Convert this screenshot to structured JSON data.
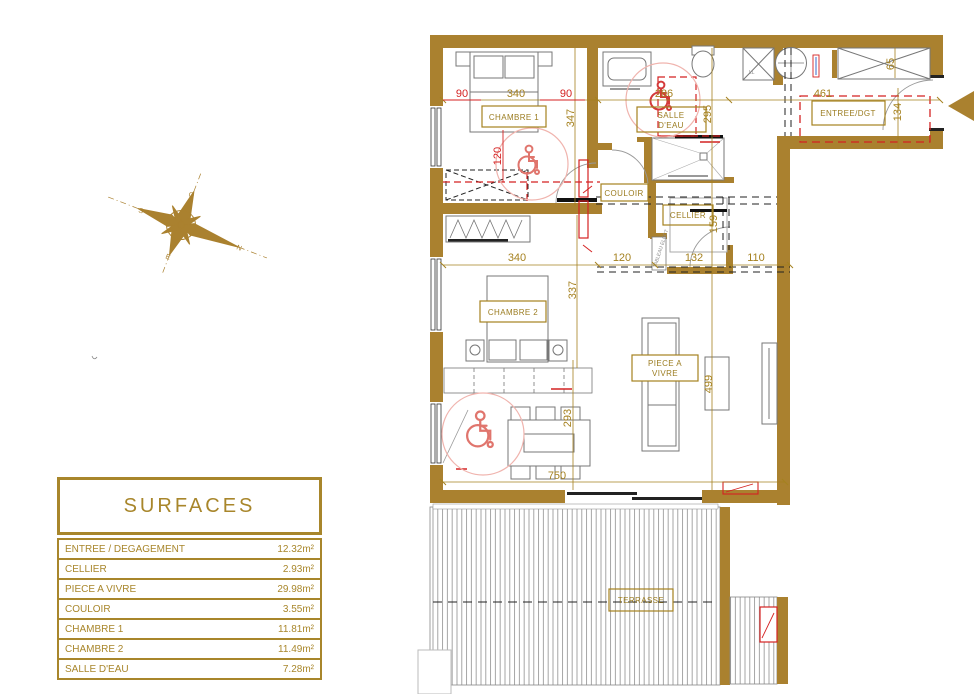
{
  "colors": {
    "wall": "#aa812f",
    "gold": "#a5811f",
    "red": "#d42222",
    "pink": "#f0b4ae",
    "furniture": "#777777"
  },
  "plan": {
    "rooms": {
      "chambre1": "CHAMBRE 1",
      "salle_deau_1": "SALLE",
      "salle_deau_2": "D'EAU",
      "entree": "ENTREE/DGT",
      "couloir": "COULOIR",
      "cellier": "CELLIER",
      "chambre2": "CHAMBRE 2",
      "piece_1": "PIECE A",
      "piece_2": "VIVRE",
      "terrasse": "TERRASSE"
    },
    "dims": {
      "ch1_width": "340",
      "ch1_height": "347",
      "sde_width": "286",
      "sde_height": "295",
      "entree_width": "461",
      "entree_depth": "134",
      "entree_top": "65",
      "ch2_width": "340",
      "ch2_height": "337",
      "couloir_width": "120",
      "cellier_width": "132",
      "degagement_width": "110",
      "cellier_height": "159",
      "living_height": "499",
      "living_left": "293",
      "living_width": "750"
    },
    "dims_red": {
      "bed_left": "90",
      "bed_right": "90",
      "bed_clear": "120"
    },
    "micro": {
      "washer": "LL",
      "elec_panel": "TABLEAU ELECT"
    }
  },
  "compass": {
    "n": "N",
    "s": "S",
    "e": "E",
    "o": "O"
  },
  "surfaces_table": {
    "title": "SURFACES",
    "rows": [
      {
        "label": "ENTREE / DEGAGEMENT",
        "value": "12.32m²"
      },
      {
        "label": "CELLIER",
        "value": "2.93m²"
      },
      {
        "label": "PIECE A VIVRE",
        "value": "29.98m²"
      },
      {
        "label": "COULOIR",
        "value": "3.55m²"
      },
      {
        "label": "CHAMBRE 1",
        "value": "11.81m²"
      },
      {
        "label": "CHAMBRE 2",
        "value": "11.49m²"
      },
      {
        "label": "SALLE D'EAU",
        "value": "7.28m²"
      }
    ]
  }
}
